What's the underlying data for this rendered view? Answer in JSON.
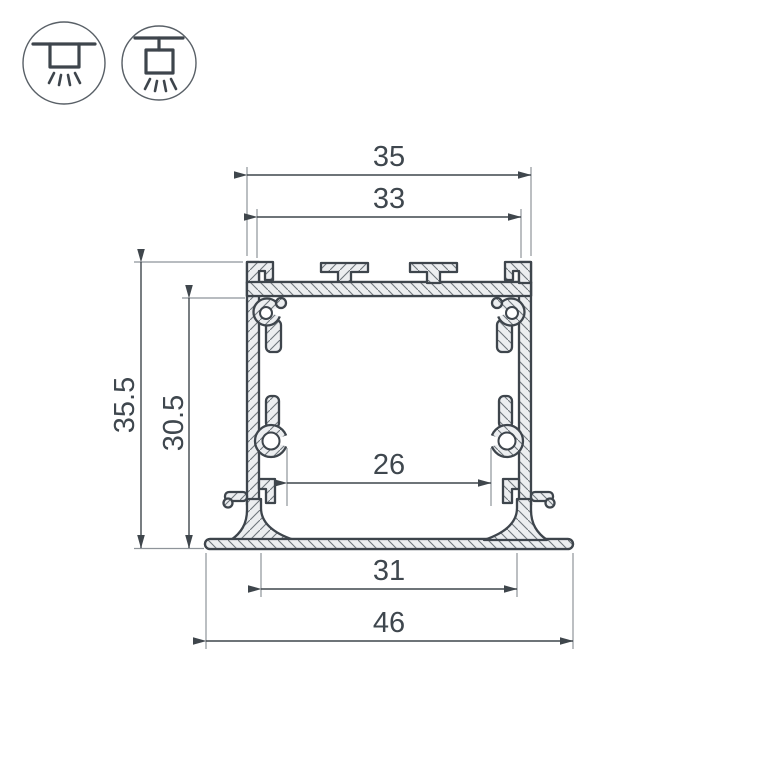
{
  "title": "aluminum-led-profile-cross-section",
  "icons": {
    "mount_recessed": "recessed-mount-icon",
    "mount_pendant": "pendant-mount-icon"
  },
  "dimensions": {
    "width_overall_top": "35",
    "width_top_opening": "33",
    "height_overall": "35.5",
    "height_internal": "30.5",
    "width_internal": "26",
    "width_recess": "31",
    "width_flange": "46"
  },
  "colors": {
    "line": "#3e454c",
    "dim": "#3f464c",
    "ext": "#8e949a",
    "fill": "#eceef0",
    "hatch": "#6e757b",
    "text": "#3f474e",
    "bg": "#ffffff"
  }
}
